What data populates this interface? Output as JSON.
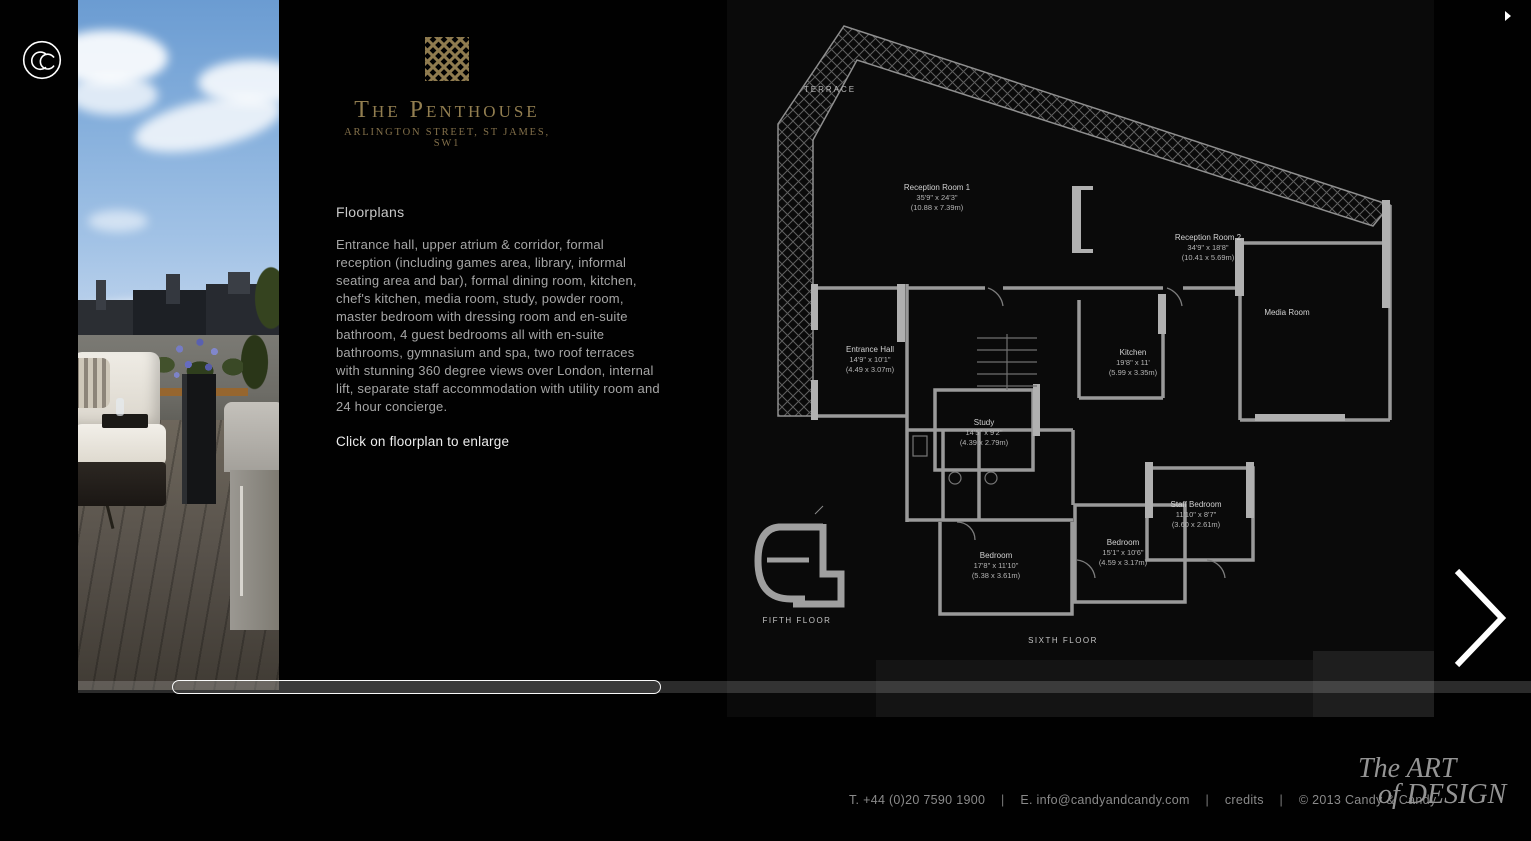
{
  "brand": {
    "name": "The Penthouse",
    "subtitle": "ARLINGTON STREET, ST JAMES, SW1"
  },
  "nav": {
    "property_details": "Property details"
  },
  "content": {
    "heading": "Floorplans",
    "description": "Entrance hall, upper atrium & corridor, formal reception (including games area, library, informal seating area and bar), formal dining room, kitchen, chef's kitchen, media room, study, powder room, master bedroom with dressing room and en-suite bathroom, 4 guest bedrooms all with en-suite bathrooms, gymnasium and spa, two roof terraces with stunning 360 degree views over London, internal lift, separate staff accommodation with utility room and 24 hour concierge.",
    "enlarge_hint": "Click on floorplan to enlarge"
  },
  "floorplan": {
    "terrace": "TERRACE",
    "media_room": "Media Room",
    "fifth_floor": "FIFTH FLOOR",
    "sixth_floor": "SIXTH FLOOR",
    "rooms": [
      {
        "name": "Reception Room 1",
        "imperial": "35'9\" x 24'3\"",
        "metric": "(10.88 x 7.39m)"
      },
      {
        "name": "Reception Room 2",
        "imperial": "34'9\" x 18'8\"",
        "metric": "(10.41 x 5.69m)"
      },
      {
        "name": "Entrance Hall",
        "imperial": "14'9\" x 10'1\"",
        "metric": "(4.49 x 3.07m)"
      },
      {
        "name": "Kitchen",
        "imperial": "19'8\" x 11'",
        "metric": "(5.99 x 3.35m)"
      },
      {
        "name": "Study",
        "imperial": "14'5\" x 9'2\"",
        "metric": "(4.39 x 2.79m)"
      },
      {
        "name": "Staff Bedroom",
        "imperial": "11'10\" x 8'7\"",
        "metric": "(3.60 x 2.61m)"
      },
      {
        "name": "Bedroom",
        "imperial": "15'1\" x 10'6\"",
        "metric": "(4.59 x 3.17m)"
      },
      {
        "name": "Bedroom",
        "imperial": "17'8\" x 11'10\"",
        "metric": "(5.38 x 3.61m)"
      }
    ]
  },
  "footer": {
    "phone": "T. +44 (0)20 7590 1900",
    "email": "E. info@candyandcandy.com",
    "credits": "credits",
    "copyright": "© 2013 Candy & Candy",
    "separator": "|"
  },
  "art_logo": {
    "line1": "The ART",
    "line2": "of DESIGN"
  },
  "colors": {
    "gold_accent": "#8f7b4f",
    "background": "#000000",
    "plan_lines": "#9a9a9a",
    "body_text": "#a6a6a6"
  }
}
